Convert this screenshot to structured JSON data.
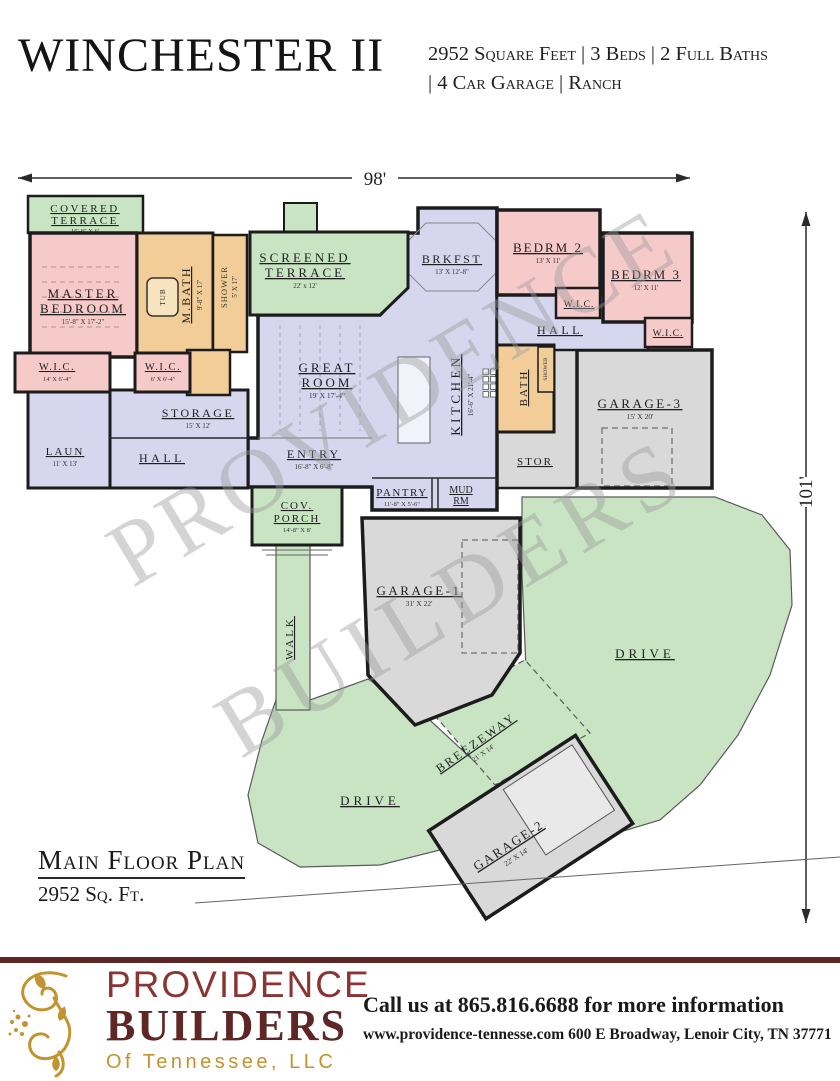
{
  "header": {
    "title": "WINCHESTER II",
    "specs_line1": "2952 Square Feet | 3 Beds | 2 Full Baths",
    "specs_line2": "| 4 Car Garage | Ranch"
  },
  "dimensions": {
    "width": "98'",
    "height": "101'"
  },
  "watermark": {
    "line1": "PROVIDENCE",
    "line2": "BUILDERS"
  },
  "rooms": {
    "covered_terrace": {
      "l1": "COVERED",
      "l2": "TERRACE",
      "dims": "16'-8\" X 6'"
    },
    "master_bedroom": {
      "l1": "MASTER",
      "l2": "BEDROOM",
      "dims": "15'-8\" X 17'-2\""
    },
    "m_bath": {
      "l1": "M.BATH",
      "dims": "9'-8\" X 17'"
    },
    "tub": {
      "l1": "TUB"
    },
    "shower_master": {
      "l1": "SHOWER",
      "dims": "5' X 17'"
    },
    "wic_master_1": {
      "l1": "W.I.C.",
      "dims": "14' X 6'-4\""
    },
    "wic_master_2": {
      "l1": "W.I.C.",
      "dims": "6' X 6'-4\""
    },
    "laundry": {
      "l1": "LAUN",
      "dims": "11' X 13'"
    },
    "storage": {
      "l1": "STORAGE",
      "dims": "15' X 12'"
    },
    "hall_left": {
      "l1": "HALL"
    },
    "screened_terrace": {
      "l1": "SCREENED",
      "l2": "TERRACE",
      "dims": "22' x 12'"
    },
    "great_room": {
      "l1": "GREAT",
      "l2": "ROOM",
      "dims": "19' X 17'-4\""
    },
    "entry": {
      "l1": "ENTRY",
      "dims": "16'-8\" X 6'-8\""
    },
    "cov_porch": {
      "l1": "COV.",
      "l2": "PORCH",
      "dims": "14'-8\" X 8'"
    },
    "brkfst": {
      "l1": "BRKFST",
      "dims": "13' X 12'-8\""
    },
    "kitchen": {
      "l1": "KITCHEN",
      "dims": "16'-6\" X 21'-4\""
    },
    "pantry": {
      "l1": "PANTRY",
      "dims": "11'-8\" X 5'-6\""
    },
    "mud_rm": {
      "l1": "MUD",
      "l2": "RM"
    },
    "bedrm_2": {
      "l1": "BEDRM 2",
      "dims": "13' X 11'"
    },
    "bedrm_3": {
      "l1": "BEDRM 3",
      "dims": "12' X 11'"
    },
    "wic_bedrm_2": {
      "l1": "W.I.C."
    },
    "wic_bedrm_3": {
      "l1": "W.I.C."
    },
    "hall_right": {
      "l1": "HALL"
    },
    "bath": {
      "l1": "BATH"
    },
    "shower_bath": {
      "l1": "SHOWER"
    },
    "stor": {
      "l1": "STOR"
    },
    "garage_3": {
      "l1": "GARAGE-3",
      "dims": "15' X 20'"
    },
    "garage_1": {
      "l1": "GARAGE-1",
      "dims": "31' X 22'"
    },
    "garage_2": {
      "l1": "GARAGE-2",
      "dims": "22' X 14'"
    },
    "breezeway": {
      "l1": "BREEZEWAY",
      "dims": "21' X 14'"
    },
    "walk": {
      "l1": "WALK"
    },
    "drive_left": {
      "l1": "DRIVE"
    },
    "drive_right": {
      "l1": "DRIVE"
    }
  },
  "plan_label": {
    "title": "Main Floor Plan",
    "subtitle": "2952 Sq. Ft."
  },
  "footer": {
    "brand_line1": "PROVIDENCE",
    "brand_line2": "BUILDERS",
    "brand_line3": "Of Tennessee, LLC",
    "contact_line1": "Call us at 865.816.6688 for more information",
    "contact_line2": "www.providence-tennesse.com 600 E Broadway, Lenoir City, TN 37771"
  },
  "colors": {
    "bedroom_pink": "#f7caca",
    "bath_tan": "#f2cd97",
    "living_lavender": "#d6d6ee",
    "outdoor_green": "#c8e4c3",
    "garage_gray": "#d9d9d9",
    "wall": "#1c1c1c",
    "brand_maroon": "#5e2726",
    "brand_gold": "#c2932e"
  }
}
